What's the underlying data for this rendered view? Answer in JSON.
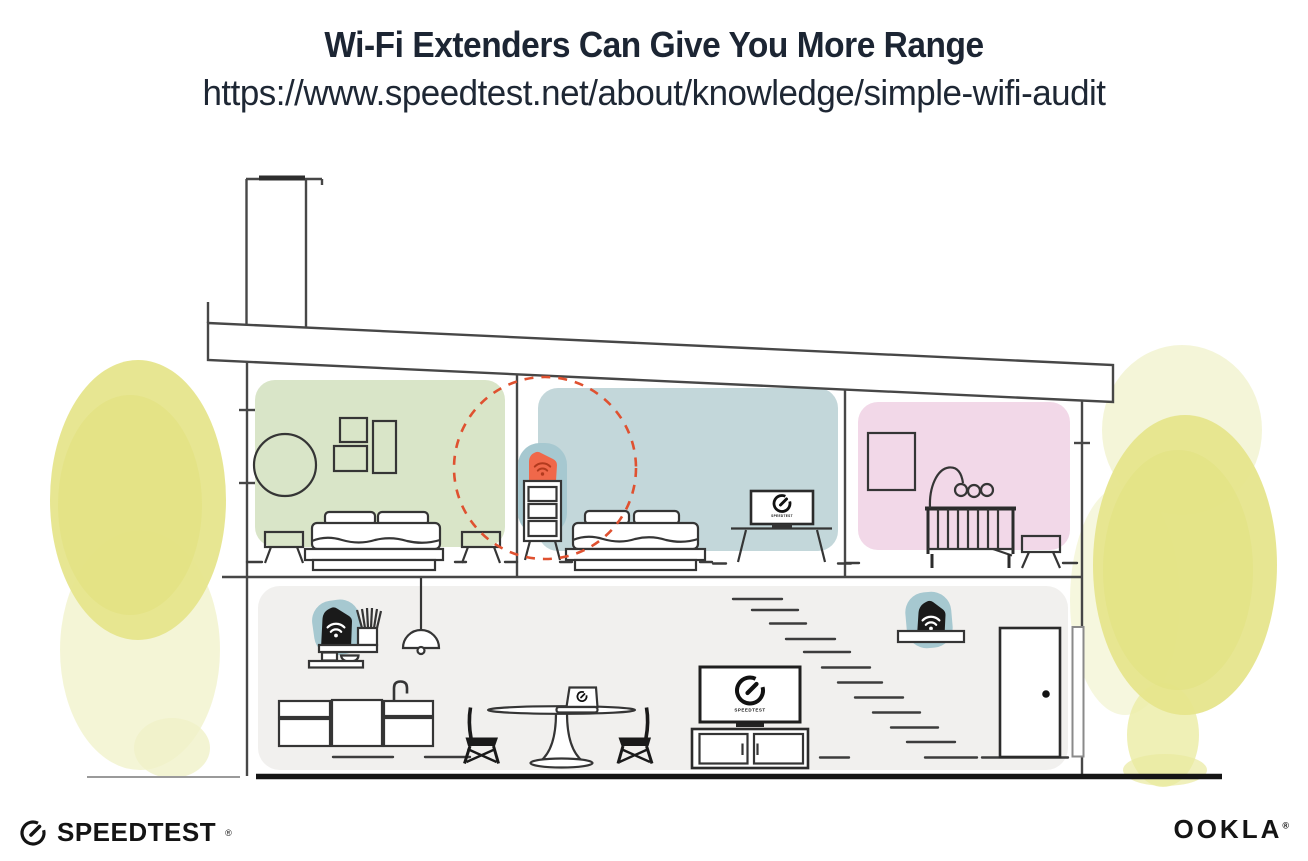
{
  "header": {
    "title": "Wi-Fi Extenders Can Give You More Range",
    "url": "https://www.speedtest.net/about/knowledge/simple-wifi-audit"
  },
  "house": {
    "screen_label": "SPEEDTEST"
  },
  "footer": {
    "speedtest": "SPEEDTEST",
    "speedtest_reg": "®",
    "ookla": "OOKLA",
    "ookla_reg": "®"
  },
  "colors": {
    "title_text": "#1c2533",
    "room_green": "#d9e5c8",
    "room_blue": "#c3d7da",
    "room_pink": "#f2d8e8",
    "lower_floor": "#f1f0ee",
    "extender_teal": "#a6c8d0",
    "extender_orange": "#f0684a",
    "wifi_on_orange": "#b23a1e",
    "extender_black": "#1a1a1a",
    "dashed_circle": "#df5130",
    "foliage": "#e6e58c",
    "foliage_light": "#f0f1c8",
    "line": "#474747",
    "logo": "#141414"
  }
}
